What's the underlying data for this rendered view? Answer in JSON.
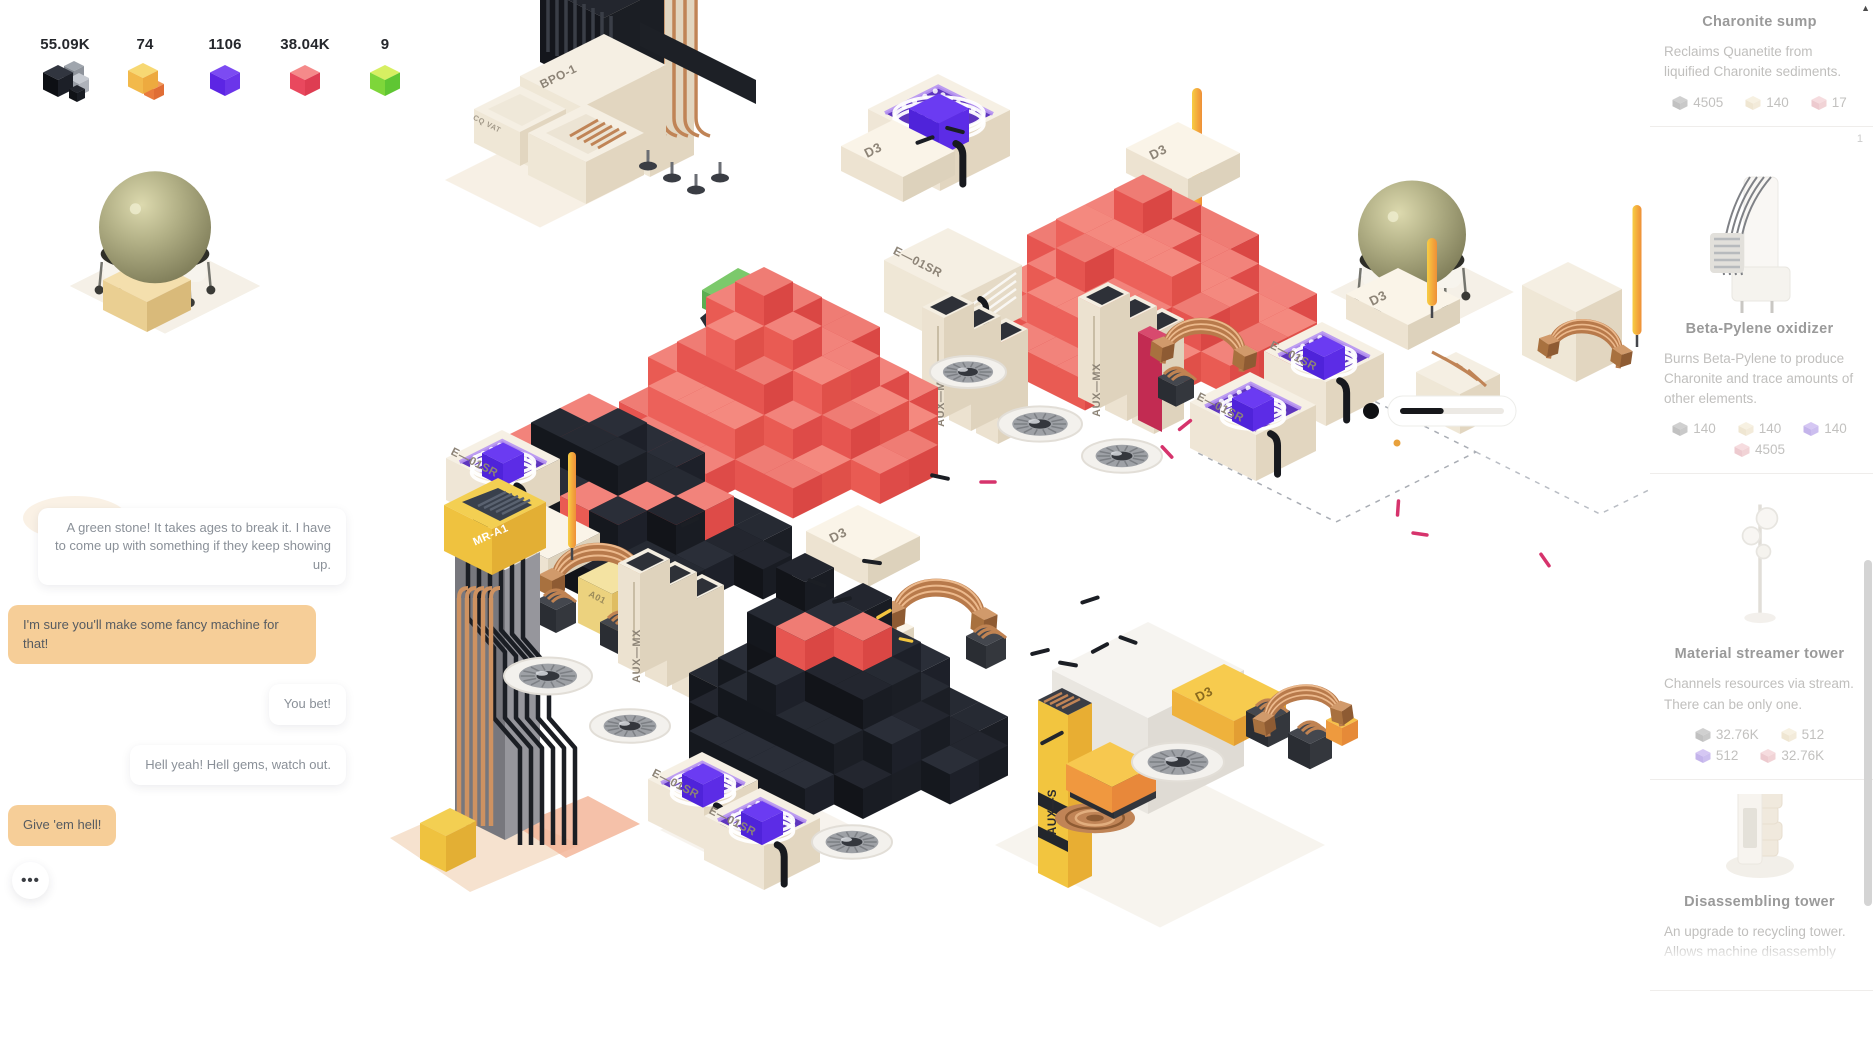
{
  "resources": {
    "counters": [
      {
        "id": "quanetite",
        "icon": "black-cubes-icon",
        "value": "55.09K"
      },
      {
        "id": "beta-pylene",
        "icon": "yellow-cube-icon",
        "value": "74"
      },
      {
        "id": "violet-element",
        "icon": "purple-cube-icon",
        "value": "1106"
      },
      {
        "id": "charonite",
        "icon": "red-cube-icon",
        "value": "38.04K"
      },
      {
        "id": "green-gem",
        "icon": "green-cube-icon",
        "value": "9"
      }
    ]
  },
  "chat": {
    "messages": [
      {
        "text": "A green stone! It takes ages to break it. I have to come up with something if they keep showing up.",
        "style": "white",
        "align": "right"
      },
      {
        "text": "I'm sure you'll make some fancy machine for that!",
        "style": "tan",
        "align": "left"
      },
      {
        "text": "You bet!",
        "style": "white",
        "align": "right"
      },
      {
        "text": "Hell yeah! Hell gems, watch out.",
        "style": "white",
        "align": "left"
      },
      {
        "text": "Give 'em hell!",
        "style": "tan",
        "align": "left"
      }
    ],
    "more_label": "•••"
  },
  "scene": {
    "labels": {
      "bpo": "BPO-1",
      "cq_vat": "CQ VAT",
      "dh3": "DH3",
      "d3": "D3",
      "e01sr": "E—01SR",
      "aux_mx": "AUX—MX",
      "aux_s": "AUX—S",
      "mr_a1": "MR-A1",
      "a01": "A01"
    },
    "progress_bar": {
      "fill_ratio": 0.42
    }
  },
  "sidebar": {
    "cards": [
      {
        "title": "Charonite sump",
        "badge": "",
        "image": "",
        "description": "Reclaims Quanetite from liquified Charonite sediments.",
        "costs": [
          {
            "icon": "gray-cube-icon",
            "value": "4505"
          },
          {
            "icon": "beige-cube-icon",
            "value": "140"
          },
          {
            "icon": "pink-cube-icon",
            "value": "17"
          }
        ]
      },
      {
        "title": "Beta-Pylene oxidizer",
        "badge": "1",
        "image": "oxidizer",
        "description": "Burns Beta-Pylene to produce Charonite and trace amounts of other elements.",
        "costs": [
          {
            "icon": "gray-cube-icon",
            "value": "140"
          },
          {
            "icon": "beige-cube-icon",
            "value": "140"
          },
          {
            "icon": "purple-cube-icon",
            "value": "140"
          },
          {
            "icon": "pink-cube-icon",
            "value": "4505"
          }
        ]
      },
      {
        "title": "Material streamer tower",
        "badge": "",
        "image": "streamer",
        "description": "Channels resources via stream. There can be only one.",
        "costs": [
          {
            "icon": "gray-cube-icon",
            "value": "32.76K"
          },
          {
            "icon": "beige-cube-icon",
            "value": "512"
          },
          {
            "icon": "purple-cube-icon",
            "value": "512"
          },
          {
            "icon": "pink-cube-icon",
            "value": "32.76K"
          }
        ]
      },
      {
        "title": "Disassembling tower",
        "badge": "",
        "image": "disassembler",
        "description": "An upgrade to recycling tower. Allows machine disassembly",
        "costs": []
      }
    ]
  },
  "colors": {
    "accent_tan_bubble": "#f6ce98",
    "red_cube_top": "#f2837b",
    "black_cube_top": "#262a33",
    "blue_cube": "#6b3bf2",
    "purple_tray": "#5e35be",
    "copper": "#b87a4b",
    "dome_green": "#a8a67c",
    "pole_yellow": "#f7ce44"
  }
}
